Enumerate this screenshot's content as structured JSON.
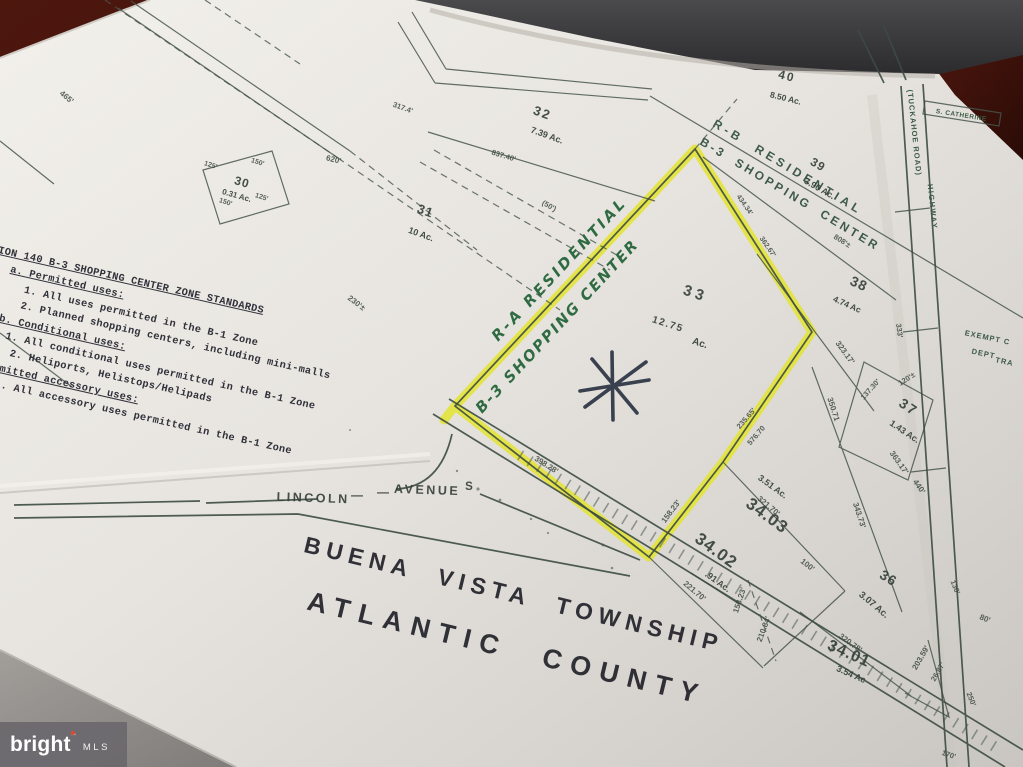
{
  "watermark": {
    "brand": "bright",
    "tm": "™",
    "org": "MLS"
  },
  "title": {
    "line1": "BUENA VISTA TOWNSHIP",
    "line2": "ATLANTIC COUNTY"
  },
  "standards": {
    "lines": [
      "ION 140 B-3 SHOPPING CENTER ZONE STANDARDS",
      "a. Permitted uses:",
      "1.  All uses permitted in the B-1 Zone",
      "2.  Planned shopping centers, including mini-malls",
      "b. Conditional uses:",
      "1.  All conditional uses permitted in the B-1 Zone",
      "2.  Heliports, Helistops/Helipads",
      "Permitted accessory uses:",
      "1.  All accessory uses permitted in the B-1 Zone"
    ]
  },
  "zones": {
    "rb_stamp": "R-B RESIDENTIAL",
    "b3_stamp": "B-3 SHOPPING CENTER",
    "ra_hand": "R-A RESIDENTIAL",
    "b3_hand": "B-3 SHOPPING CENTER",
    "exempt": [
      "EXEMPT C",
      "DEPT",
      "TRA"
    ]
  },
  "roads": {
    "lincoln": [
      "LINCOLN",
      "—",
      "AVENUE",
      "S"
    ],
    "tuckahoe": "(TUCKAHOE ROAD)",
    "highway": "HIGHWAY",
    "catherine": "S. CATHERINE"
  },
  "parcels": [
    {
      "lot": "30",
      "acreage": "0.31 Ac."
    },
    {
      "lot": "31",
      "acreage": "10 Ac."
    },
    {
      "lot": "32",
      "acreage": "7.39 Ac."
    },
    {
      "lot": "33",
      "acreage_value": "12.75",
      "acreage_unit": "Ac."
    },
    {
      "lot": "34.01",
      "acreage": "3.54 Ac"
    },
    {
      "lot": "34.02",
      "acreage": ".91 Ac."
    },
    {
      "lot": "34.03",
      "acreage": "3.51 Ac."
    },
    {
      "lot": "36",
      "acreage": "3.07 Ac."
    },
    {
      "lot": "37",
      "acreage": "1.43 Ac."
    },
    {
      "lot": "38",
      "acreage": "4.74 Ac"
    },
    {
      "lot": "39",
      "acreage": "3.90 Ac."
    },
    {
      "lot": "40",
      "acreage": "8.50 Ac."
    }
  ],
  "dims": [
    "620'",
    "230'±",
    "465'",
    "317.4'",
    "(50')",
    "837.40'",
    "125'",
    "150'",
    "150'",
    "125'",
    "398.28'",
    "158.23'",
    "235.65'",
    "576.70",
    "434.34'",
    "362.67'",
    "321.70'",
    "221.70'",
    "158.23'",
    "210.84'",
    "100'",
    "343.73'",
    "320.78'",
    "203.59'",
    "26.87'",
    "130'",
    "80'",
    "250'",
    "170'",
    "323.17'",
    "350.71",
    "363.17'",
    "440'",
    "137.30'",
    "120'±",
    "808'±",
    "333'"
  ],
  "colors": {
    "highlight": "#e3e330",
    "ink": "#46554b",
    "paper": "#e9e6e1"
  }
}
